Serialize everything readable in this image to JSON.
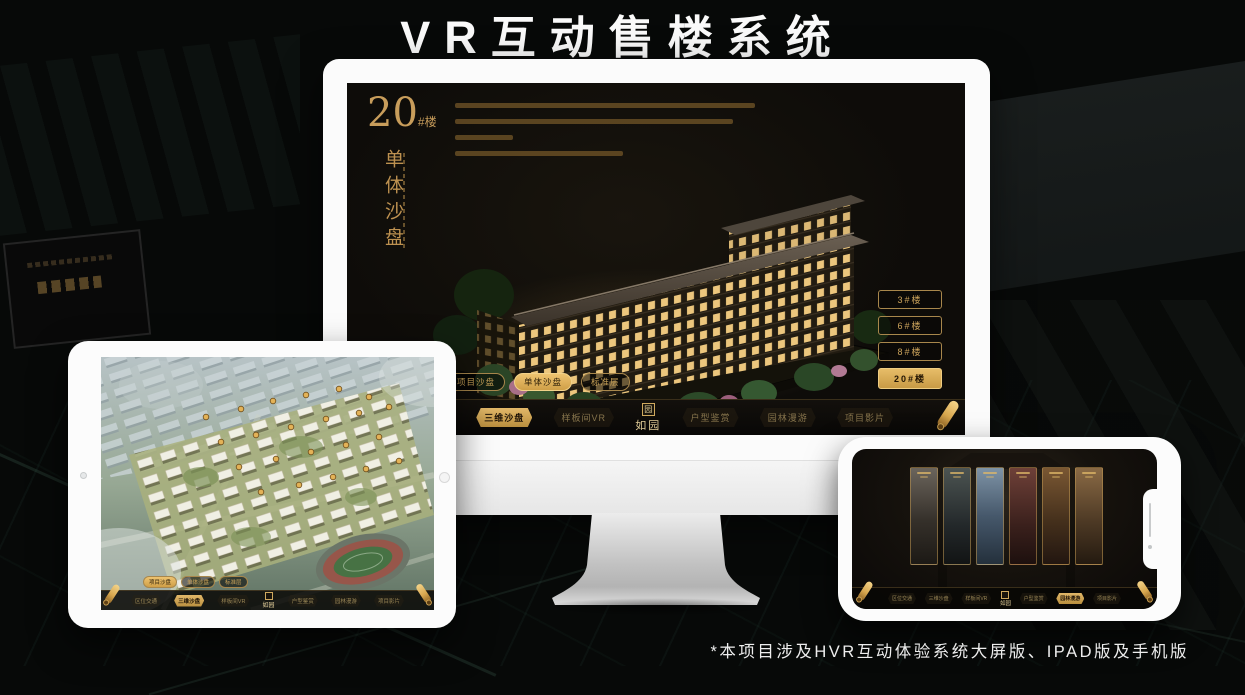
{
  "page": {
    "title": "VR互动售楼系统",
    "footnote": "*本项目涉及HVR互动体验系统大屏版、IPAD版及手机版"
  },
  "colors": {
    "gold": "#D8A74F",
    "gold_bright": "#EEC370",
    "gold_text": "#C9A258",
    "screen_black": "#0E0C09",
    "background": "#070908",
    "device_white": "#FCFCFC"
  },
  "app": {
    "logo": "如园",
    "logo_seal_glyph": "园",
    "nav_items": [
      "区位交通",
      "三维沙盘",
      "样板间VR",
      "户型鉴赏",
      "园林漫游",
      "项目影片"
    ],
    "mode_pills": [
      "项目沙盘",
      "单体沙盘",
      "标准层"
    ]
  },
  "monitor": {
    "block_number": "20",
    "block_suffix": "#楼",
    "block_subtitle": "单体沙盘",
    "floor_buttons": [
      {
        "label": "3#楼",
        "active": false
      },
      {
        "label": "6#楼",
        "active": false
      },
      {
        "label": "8#楼",
        "active": false
      },
      {
        "label": "20#楼",
        "active": true
      }
    ],
    "active_pill": "单体沙盘",
    "active_nav": "三维沙盘"
  },
  "ipad": {
    "active_pill": "项目沙盘",
    "active_nav": "三维沙盘"
  },
  "phone": {
    "active_nav": "园林漫游"
  }
}
